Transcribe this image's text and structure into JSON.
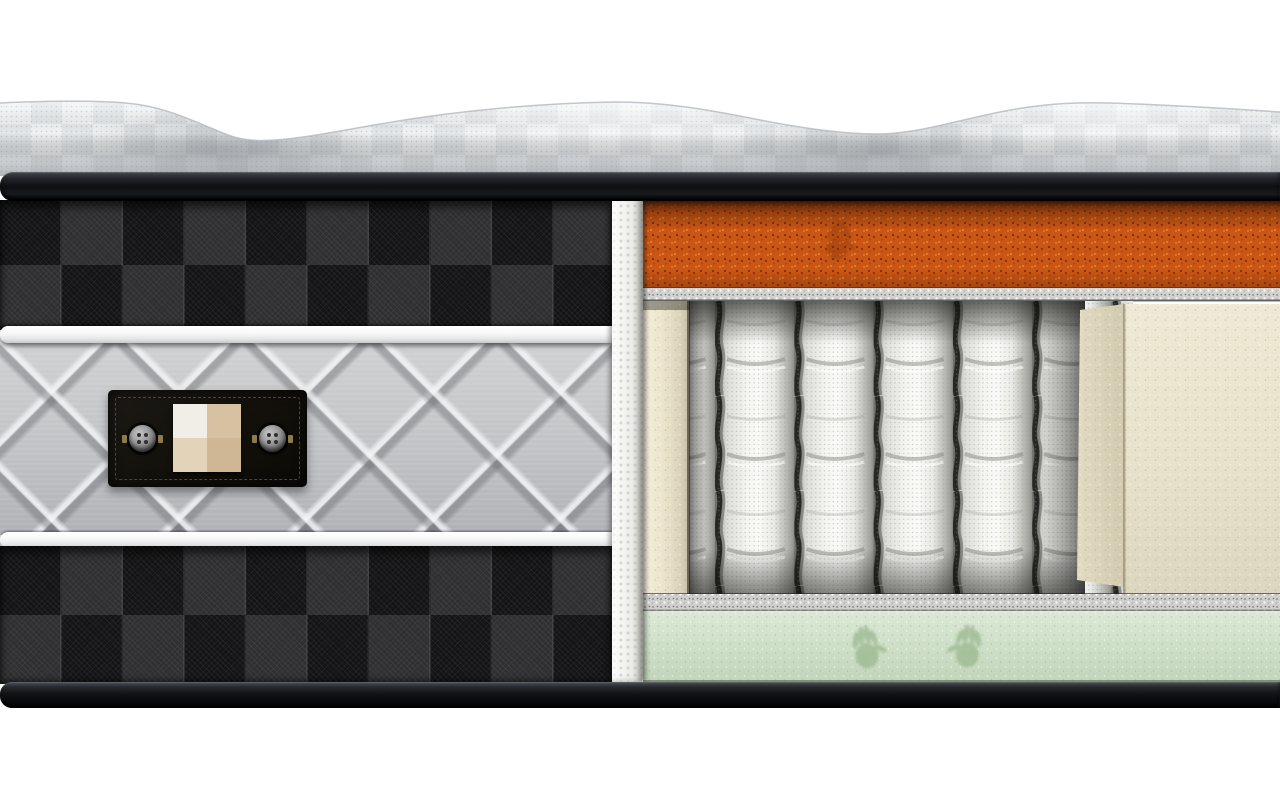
{
  "scene": {
    "title": "Cross-section cutaway render of a hybrid pocket-spring mattress",
    "background_color": "#ffffff",
    "visible_text": "none"
  },
  "exterior": {
    "top_panel": {
      "name": "Quilted knit sleep surface (wavy)",
      "color": "#f0f2f3"
    },
    "top_binding": {
      "name": "Black binding tape",
      "color": "#17191c"
    },
    "side_panel": {
      "name": "Charcoal plaid side fabric",
      "base_color": "#17171a",
      "check_size_px": 62
    },
    "piping": {
      "name": "White piping cords",
      "color": "#f4f4f5",
      "count": 2
    },
    "quilted_border": {
      "name": "Grey plush quilted border band",
      "color": "#c2c3c6"
    },
    "bottom_binding": {
      "name": "Black binding tape",
      "color": "#131417"
    }
  },
  "label": {
    "name": "Black fabric tag with buttons and fabric swatch",
    "background": "#14110e",
    "stitch_color": "#4a453f",
    "buttons": {
      "count": 2,
      "color": "#949494"
    },
    "swatch": {
      "rows": 2,
      "cols": 2,
      "colors": [
        "#f1eee8",
        "#d7c1a1",
        "#e3d3b9",
        "#cfb795"
      ]
    }
  },
  "cut_edge": {
    "name": "Cut edge of quilted cover",
    "color": "#f1f1ef"
  },
  "cutaway_layers": [
    {
      "name": "Orange memory-foam comfort layer",
      "color": "#c95614",
      "handprints": 1
    },
    {
      "name": "Felt insulator pad (upper)",
      "color": "#d2d2d0"
    },
    {
      "name": "Fabric-wrapped pocket springs",
      "fabric_color": "#f0f0ed",
      "gap_color": "#262622",
      "visible_coils": 6,
      "coil_pitch_px": 79
    },
    {
      "name": "Foam encasement side rail",
      "color": "#ebe4cc"
    },
    {
      "name": "Foam encasement corner block",
      "color": "#e8e1cb"
    },
    {
      "name": "Felt insulator pad (lower)",
      "color": "#cfcfcd"
    },
    {
      "name": "Green memory-foam base layer",
      "color": "#cfe0c8",
      "handprints": 2
    }
  ]
}
